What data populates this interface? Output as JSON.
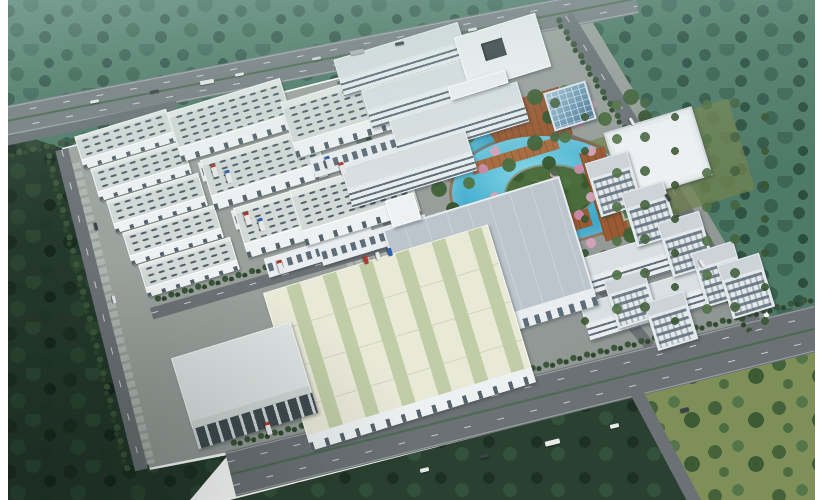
{
  "scene": {
    "title": "Aerial architectural rendering of an industrial business park",
    "type": "architectural-rendering",
    "text_visible": "",
    "frame": {
      "color": "#ffffff",
      "left_strip_px": 8,
      "right_strip_px": 25
    },
    "palette": {
      "ground": "#9aa09c",
      "forest_top": "#4e7a68",
      "forest_dark": "#24382b",
      "meadow": "#7e8f58",
      "road": "#6b7175",
      "highway": "#787e82",
      "median_green": "#4b6b4f",
      "lake": "#3ba4c6",
      "island": "#4a6b3a",
      "plaza_deck": "#9a5a33",
      "factory_roof": "#d2d9d6",
      "skylight_dash": "#4e5e68",
      "facade_white": "#eef1f2",
      "slab_roof": "#d8dee1",
      "window_band": "#5d6d79",
      "flat_roof": "#bcc5cc",
      "cream_roof": "#e9e9d8",
      "cream_skylight": "#c0cda6",
      "tower_wall": "#e4e9ec",
      "glass_blue": "#6f9ab5",
      "gym_roof": "#eef1f3",
      "court_green": "#5d7c54",
      "court_red": "#a05438",
      "blossom_pink": "#d29fb6",
      "truck_red": "#b03a2e",
      "truck_blue": "#2e5fb0",
      "car_white": "#e8eaea",
      "car_dark": "#3a4246"
    },
    "areas": [
      {
        "name": "top-forest",
        "desc": "hazy teal tree belt beyond the highway"
      },
      {
        "name": "highway",
        "desc": "multi-lane highway with vehicles crossing the top"
      },
      {
        "name": "factory-grid",
        "desc": "rows of gable-roof warehouses with skylight strips and loading docks"
      },
      {
        "name": "office-slabs",
        "desc": "four long multi-storey buildings with ribbon windows"
      },
      {
        "name": "courtyard-building",
        "desc": "white flat building with square atrium"
      },
      {
        "name": "glass-cube",
        "desc": "blue curtain-wall cube building"
      },
      {
        "name": "central-garden",
        "desc": "turquoise lake, planted island, terracotta deck plaza, blossom trees"
      },
      {
        "name": "tower-cluster",
        "desc": "seven mid-rise towers and two dormitory slabs on the east side"
      },
      {
        "name": "gym-court",
        "desc": "white sports hall with outdoor basketball court"
      },
      {
        "name": "big-flat-warehouse",
        "desc": "large flat pale-blue roof logistics hall"
      },
      {
        "name": "cream-warehouse",
        "desc": "large cream roof hall with green skylight bands"
      },
      {
        "name": "boulevard",
        "desc": "wide tree-lined avenue along the south edge"
      },
      {
        "name": "dark-forest",
        "desc": "dense dark woodland on the south-west"
      },
      {
        "name": "meadow",
        "desc": "light green field with scattered trees on the south-east"
      }
    ],
    "counts": {
      "small_warehouses": 5,
      "large_warehouses": 6,
      "office_slabs": 4,
      "towers": 7,
      "dorm_slabs": 2
    }
  }
}
